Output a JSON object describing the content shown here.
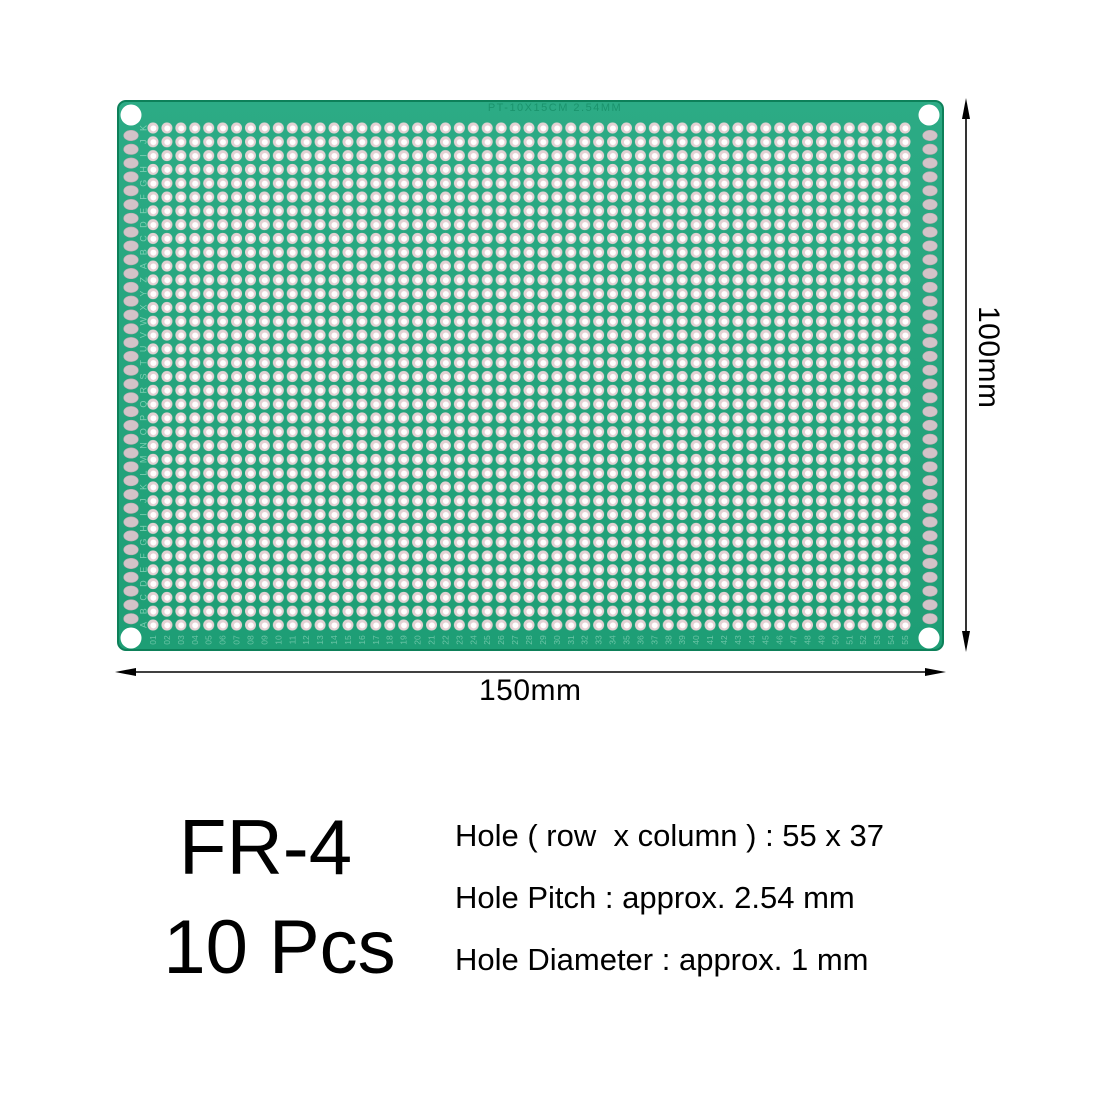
{
  "product": {
    "material": "FR-4",
    "quantity": "10 Pcs"
  },
  "specs": {
    "holes": "Hole ( row  x column ) : 55 x 37",
    "pitch": "Hole Pitch : approx. 2.54 mm",
    "diameter": "Hole Diameter : approx. 1 mm"
  },
  "dimensions": {
    "width_label": "150mm",
    "height_label": "100mm"
  },
  "board": {
    "silkscreen_title": "PT-10X15CM 2.54MM",
    "grid_rows": 37,
    "grid_cols": 55,
    "row_label_alphabet": "ABCDEFGHIJKLMNOPQRSTUVWXYZ",
    "colors": {
      "board_top": "#2CAB85",
      "board_bottom": "#1E9E75",
      "board_edge": "#0D8059",
      "hole_ring": "#E4D1D3",
      "hole_center": "#FFFFFF",
      "edge_pad": "#D3C3C8",
      "edge_pad_stroke": "#BFAEB4",
      "silkscreen": "#9FDEC7",
      "mounting_hole": "#FFFFFF",
      "annotation": "#000000"
    }
  }
}
